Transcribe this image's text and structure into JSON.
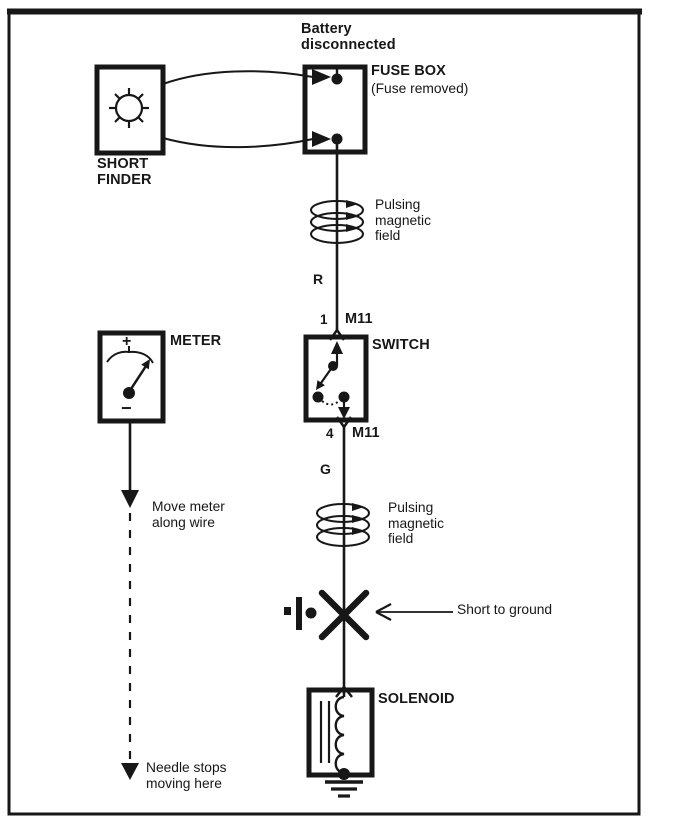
{
  "colors": {
    "ink": "#171717",
    "paper": "#ffffff"
  },
  "labels": {
    "battery_note": "Battery disconnected",
    "fuse_box": "FUSE BOX",
    "fuse_box_sub": "(Fuse removed)",
    "short_finder": "SHORT FINDER",
    "pulsing_field_top": "Pulsing magnetic field",
    "wire_color_top": "R",
    "connector_top_pin": "1",
    "connector_top_name": "M11",
    "switch": "SWITCH",
    "connector_bottom_pin": "4",
    "connector_bottom_name": "M11",
    "wire_color_bottom": "G",
    "pulsing_field_bottom": "Pulsing magnetic field",
    "short_to_ground": "Short to ground",
    "solenoid": "SOLENOID",
    "meter": "METER",
    "meter_plus": "+",
    "meter_minus": "−",
    "move_meter": "Move meter along wire",
    "needle_stops": "Needle stops moving here"
  }
}
